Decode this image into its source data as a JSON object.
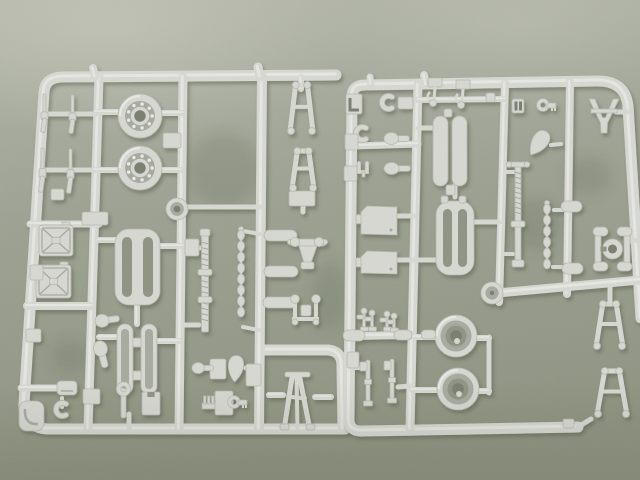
{
  "scene": {
    "kind": "photograph",
    "subject": "two light-grey injection-moulded plastic model-kit sprues (parts trees) with road wheels, bearing wheels, jerry cans, slotted plates, threaded rods, trestle frames, panels and small fittings",
    "surface": "olive-green textured mat"
  },
  "palette": {
    "bg_top": "#b4b7aa",
    "bg_mid": "#9da293",
    "bg_low": "#8e9381",
    "plastic": "#d7d8d2",
    "plastic_light": "#ecede8",
    "plastic_dark": "#b6b8ae",
    "plastic_deep": "#a7aa9f",
    "recess": "#8f9384",
    "hole": "#7a7e70",
    "highlight": "#dadccf",
    "cast_shadow": "#50553f"
  },
  "background": {
    "smudges": [
      {
        "cx": 224,
        "cy": 170,
        "rx": 38,
        "ry": 36
      },
      {
        "cx": 536,
        "cy": 224,
        "rx": 27,
        "ry": 26
      },
      {
        "cx": 588,
        "cy": 176,
        "rx": 23,
        "ry": 19
      },
      {
        "cx": 330,
        "cy": 296,
        "rx": 18,
        "ry": 34
      },
      {
        "cx": 70,
        "cy": 356,
        "rx": 18,
        "ry": 16
      }
    ]
  },
  "sprues": [
    {
      "name": "left-sprue",
      "frames": [
        "M336,75 L61,77 Q45,78 44,92 L24,404 Q23,427 47,429 L345,429",
        "M263,350 L328,350 Q341,351 342,364 L343,429"
      ],
      "lines": [
        [
          99,
          77,
          88,
          429,
          9
        ],
        [
          183,
          77,
          179,
          429,
          9
        ],
        [
          262,
          77,
          259,
          429,
          10
        ],
        [
          30,
          224,
          99,
          224,
          7
        ],
        [
          27,
          306,
          92,
          306,
          8
        ],
        [
          21,
          388,
          58,
          388,
          7
        ],
        [
          46,
          114,
          96,
          114,
          5
        ],
        [
          44,
          170,
          95,
          170,
          5
        ],
        [
          96,
          112,
          122,
          112,
          6
        ],
        [
          154,
          113,
          183,
          113,
          6
        ],
        [
          95,
          170,
          120,
          170,
          6
        ],
        [
          154,
          170,
          182,
          170,
          6
        ],
        [
          188,
          207,
          261,
          207,
          5
        ],
        [
          99,
          240,
          117,
          240,
          6
        ],
        [
          157,
          246,
          183,
          246,
          6
        ],
        [
          99,
          337,
          118,
          337,
          6
        ],
        [
          155,
          341,
          181,
          341,
          6
        ],
        [
          137,
          303,
          137,
          324,
          6
        ],
        [
          183,
          248,
          200,
          248,
          5
        ],
        [
          183,
          325,
          199,
          325,
          5
        ],
        [
          243,
          231,
          260,
          234,
          4
        ],
        [
          243,
          327,
          259,
          330,
          4
        ],
        [
          269,
          395,
          283,
          395,
          6
        ],
        [
          315,
          397,
          331,
          397,
          6
        ],
        [
          301,
          77,
          301,
          89,
          6
        ],
        [
          303,
          193,
          303,
          212,
          5
        ],
        [
          246,
          368,
          255,
          368,
          5
        ],
        [
          129,
          414,
          129,
          429,
          5
        ],
        [
          62,
          398,
          62,
          407,
          4
        ],
        [
          93,
          68,
          95,
          77,
          8
        ],
        [
          258,
          67,
          260,
          77,
          9
        ]
      ],
      "parts": [
        {
          "t": "rifle",
          "n": "rifle-part",
          "x": 43,
          "y": 94,
          "h": 39
        },
        {
          "t": "rifle",
          "n": "rifle-part",
          "x": 71,
          "y": 95,
          "h": 39
        },
        {
          "t": "rifle",
          "n": "rifle-part",
          "x": 41,
          "y": 148,
          "h": 45
        },
        {
          "t": "rifle",
          "n": "rifle-part",
          "x": 69,
          "y": 149,
          "h": 45
        },
        {
          "t": "box",
          "n": "small-block",
          "x": 51,
          "y": 189,
          "w": 13,
          "h": 11
        },
        {
          "t": "wheelL",
          "n": "bearing-wheel",
          "cx": 140,
          "cy": 116,
          "r": 22
        },
        {
          "t": "wheelL",
          "n": "bearing-wheel",
          "cx": 140,
          "cy": 168,
          "r": 22
        },
        {
          "t": "box",
          "n": "mounting-tab",
          "x": 163,
          "y": 133,
          "w": 18,
          "h": 15
        },
        {
          "t": "hub",
          "n": "wheel-hub",
          "cx": 177,
          "cy": 209,
          "r": 11
        },
        {
          "t": "ladder",
          "n": "trestle-frame",
          "x": 287,
          "y": 80,
          "w": 29,
          "h": 56
        },
        {
          "t": "box",
          "n": "mounting-tab",
          "x": 289,
          "y": 191,
          "w": 26,
          "h": 15
        },
        {
          "t": "ladder",
          "n": "trestle-frame",
          "x": 289,
          "y": 146,
          "w": 28,
          "h": 47
        },
        {
          "t": "xcan",
          "n": "jerry-can",
          "x": 39,
          "y": 225,
          "w": 34,
          "h": 31
        },
        {
          "t": "xcan",
          "n": "jerry-can",
          "x": 36,
          "y": 265,
          "w": 35,
          "h": 33
        },
        {
          "t": "box",
          "n": "mounting-tab",
          "x": 82,
          "y": 212,
          "w": 26,
          "h": 13
        },
        {
          "t": "slotplate",
          "n": "slotted-plate",
          "x": 115,
          "y": 229,
          "w": 45,
          "h": 76
        },
        {
          "t": "twincapsule",
          "n": "twin-capsule-frame",
          "x": 117,
          "y": 324,
          "w": 40,
          "h": 70
        },
        {
          "t": "box",
          "n": "mounting-tab",
          "x": 185,
          "y": 239,
          "w": 14,
          "h": 17
        },
        {
          "t": "screw",
          "n": "threaded-rod",
          "x": 205,
          "y": 234,
          "h": 98
        },
        {
          "t": "chain",
          "n": "linked-rod",
          "x": 241,
          "y": 227,
          "h": 104
        },
        {
          "t": "capsule",
          "n": "cylinder-part",
          "x": 264,
          "y": 230,
          "w": 33,
          "h": 11
        },
        {
          "t": "capsule",
          "n": "cylinder-part",
          "x": 264,
          "y": 266,
          "w": 34,
          "h": 11
        },
        {
          "t": "mountA",
          "n": "mount-bracket",
          "x": 288,
          "y": 236
        },
        {
          "t": "capsule",
          "n": "cylinder-part",
          "x": 263,
          "y": 297,
          "w": 34,
          "h": 11
        },
        {
          "t": "mountB",
          "n": "mount-bracket",
          "x": 287,
          "y": 294
        },
        {
          "t": "box",
          "n": "mounting-tab",
          "x": 246,
          "y": 364,
          "w": 15,
          "h": 22
        },
        {
          "t": "teardrop",
          "n": "teardrop-part",
          "cx": 236,
          "cy": 365,
          "r": 9.5,
          "rot": 5
        },
        {
          "t": "aframe",
          "n": "a-frame-leg",
          "x": 281,
          "y": 372,
          "w": 33,
          "h": 58
        },
        {
          "t": "paddle",
          "n": "paddle-part",
          "x": 95,
          "y": 313,
          "w": 25,
          "h": 14,
          "rot": -8
        },
        {
          "t": "paddle",
          "n": "paddle-part",
          "x": 88,
          "y": 347,
          "w": 28,
          "h": 15,
          "rot": 75
        },
        {
          "t": "box",
          "n": "mounting-tab",
          "x": 210,
          "y": 359,
          "w": 16,
          "h": 20
        },
        {
          "t": "paddle",
          "n": "paddle-part",
          "x": 192,
          "y": 362,
          "w": 22,
          "h": 12,
          "rot": 0
        },
        {
          "t": "chook",
          "n": "c-hook",
          "x": 55,
          "y": 402
        },
        {
          "t": "cornerpart",
          "n": "corner-plate",
          "x": 19,
          "y": 401,
          "w": 25,
          "h": 30
        },
        {
          "t": "box",
          "n": "small-block",
          "x": 30,
          "y": 265,
          "w": 13,
          "h": 15
        },
        {
          "t": "box",
          "n": "small-block",
          "x": 26,
          "y": 329,
          "w": 15,
          "h": 13
        },
        {
          "t": "shoe",
          "n": "small-part",
          "x": 57,
          "y": 381,
          "w": 20,
          "h": 14
        },
        {
          "t": "box",
          "n": "small-block",
          "x": 83,
          "y": 389,
          "w": 17,
          "h": 15
        },
        {
          "t": "wrench",
          "n": "wrench-part",
          "x": 120,
          "y": 383
        },
        {
          "t": "nbox",
          "n": "notched-block",
          "x": 142,
          "y": 392,
          "w": 18,
          "h": 23
        },
        {
          "t": "comb",
          "n": "comb-bracket",
          "x": 202,
          "y": 396
        },
        {
          "t": "box",
          "n": "small-block",
          "x": 215,
          "y": 391,
          "w": 18,
          "h": 24
        },
        {
          "t": "okey",
          "n": "ring-key",
          "x": 229,
          "y": 396
        }
      ]
    },
    {
      "name": "right-sprue",
      "frames": [
        "M578,427 L363,431 Q348,432 349,417 L352,97 Q352,85 365,85 L596,81 Q625,80 628,106 L641,318"
      ],
      "lines": [
        [
          418,
          85,
          410,
          429,
          9
        ],
        [
          505,
          83,
          499,
          302,
          8
        ],
        [
          570,
          82,
          567,
          294,
          8
        ],
        [
          352,
          146,
          418,
          144,
          7
        ],
        [
          418,
          100,
          505,
          99,
          6
        ],
        [
          497,
          293,
          640,
          280,
          9
        ],
        [
          352,
          336,
          412,
          335,
          8
        ],
        [
          489,
          337,
          489,
          393,
          5
        ],
        [
          396,
          216,
          416,
          216,
          5
        ],
        [
          396,
          260,
          437,
          260,
          5
        ],
        [
          472,
          222,
          499,
          222,
          5
        ],
        [
          418,
          128,
          434,
          128,
          5
        ],
        [
          455,
          185,
          455,
          197,
          5
        ],
        [
          616,
          112,
          627,
          112,
          5
        ],
        [
          551,
          145,
          561,
          144,
          4
        ],
        [
          505,
          172,
          514,
          172,
          4
        ],
        [
          505,
          254,
          513,
          254,
          4
        ],
        [
          554,
          210,
          567,
          210,
          4
        ],
        [
          553,
          267,
          567,
          267,
          4
        ],
        [
          629,
          241,
          639,
          240,
          5
        ],
        [
          412,
          337,
          436,
          337,
          6
        ],
        [
          476,
          338,
          489,
          338,
          6
        ],
        [
          412,
          390,
          438,
          390,
          6
        ],
        [
          477,
          391,
          489,
          391,
          6
        ],
        [
          398,
          387,
          410,
          386,
          5
        ],
        [
          352,
          368,
          361,
          368,
          4
        ],
        [
          610,
          287,
          610,
          300,
          5
        ],
        [
          578,
          427,
          591,
          419,
          5
        ],
        [
          424,
          75,
          426,
          85,
          8
        ],
        [
          370,
          77,
          371,
          85,
          7
        ]
      ],
      "parts": [
        {
          "t": "lshape",
          "n": "l-bracket",
          "x": 346,
          "y": 94,
          "w": 16,
          "h": 20
        },
        {
          "t": "chook",
          "n": "c-hook",
          "x": 381,
          "y": 95
        },
        {
          "t": "box",
          "n": "small-block",
          "x": 398,
          "y": 97,
          "w": 15,
          "h": 12
        },
        {
          "t": "chook",
          "n": "c-hook",
          "x": 355,
          "y": 126
        },
        {
          "t": "box",
          "n": "small-block",
          "x": 345,
          "y": 134,
          "w": 13,
          "h": 16
        },
        {
          "t": "ufork",
          "n": "fork-part",
          "x": 359,
          "y": 163
        },
        {
          "t": "box",
          "n": "small-block",
          "x": 344,
          "y": 166,
          "w": 13,
          "h": 15
        },
        {
          "t": "paddle",
          "n": "paddle-part",
          "x": 384,
          "y": 132,
          "w": 26,
          "h": 13,
          "rot": 0
        },
        {
          "t": "paddle",
          "n": "paddle-part",
          "x": 384,
          "y": 162,
          "w": 27,
          "h": 13,
          "rot": 0
        },
        {
          "t": "hookasm",
          "n": "hook-assembly",
          "x": 428,
          "y": 78
        },
        {
          "t": "hookasm",
          "n": "hook-assembly",
          "x": 456,
          "y": 80
        },
        {
          "t": "box",
          "n": "small-block",
          "x": 486,
          "y": 93,
          "w": 9,
          "h": 9
        },
        {
          "t": "capsule",
          "n": "oval-pod",
          "x": 433,
          "y": 116,
          "w": 15,
          "h": 70
        },
        {
          "t": "capsule",
          "n": "oval-pod",
          "x": 452,
          "y": 116,
          "w": 15,
          "h": 70
        },
        {
          "t": "box",
          "n": "mounting-tab",
          "x": 444,
          "y": 109,
          "w": 8,
          "h": 8
        },
        {
          "t": "box",
          "n": "mounting-tab",
          "x": 446,
          "y": 185,
          "w": 9,
          "h": 10
        },
        {
          "t": "gridpart",
          "n": "grid-buckle",
          "x": 512,
          "y": 99
        },
        {
          "t": "okey",
          "n": "ring-key",
          "x": 538,
          "y": 99
        },
        {
          "t": "teardrop",
          "n": "teardrop-part",
          "cx": 541,
          "cy": 140,
          "r": 10,
          "rot": 35
        },
        {
          "t": "vfork",
          "n": "fork-mount",
          "x": 589,
          "y": 99,
          "w": 30,
          "h": 34
        },
        {
          "t": "panel",
          "n": "hatch-panel",
          "x": 361,
          "y": 206,
          "w": 36,
          "h": 29
        },
        {
          "t": "panel",
          "n": "hatch-panel",
          "x": 361,
          "y": 251,
          "w": 36,
          "h": 23
        },
        {
          "t": "slotplate",
          "n": "slotted-plate",
          "x": 436,
          "y": 201,
          "w": 38,
          "h": 74
        },
        {
          "t": "box",
          "n": "mounting-tab",
          "x": 441,
          "y": 196,
          "w": 7,
          "h": 7
        },
        {
          "t": "box",
          "n": "mounting-tab",
          "x": 459,
          "y": 196,
          "w": 7,
          "h": 7
        },
        {
          "t": "screwjack",
          "n": "jack-screw",
          "x": 518,
          "y": 166,
          "h": 100
        },
        {
          "t": "chain",
          "n": "linked-rod",
          "x": 547,
          "y": 201,
          "h": 78
        },
        {
          "t": "capsule",
          "n": "cylinder-part",
          "x": 561,
          "y": 201,
          "w": 21,
          "h": 11
        },
        {
          "t": "capsule",
          "n": "cylinder-part",
          "x": 562,
          "y": 263,
          "w": 21,
          "h": 11
        },
        {
          "t": "hshoe",
          "n": "axle-bracket",
          "x": 593,
          "y": 227,
          "w": 39,
          "h": 44
        },
        {
          "t": "boss",
          "n": "round-boss",
          "cx": 492,
          "cy": 293,
          "r": 11
        },
        {
          "t": "wheelR",
          "n": "tire-wheel",
          "cx": 456,
          "cy": 336,
          "r": 21
        },
        {
          "t": "wheelR",
          "n": "tire-wheel",
          "cx": 458,
          "cy": 389,
          "r": 21
        },
        {
          "t": "pinfig",
          "n": "lever-part",
          "x": 364,
          "y": 308,
          "h": 22
        },
        {
          "t": "pinfig",
          "n": "lever-part",
          "x": 372,
          "y": 310,
          "h": 20
        },
        {
          "t": "pinfig",
          "n": "lever-part",
          "x": 387,
          "y": 311,
          "h": 19
        },
        {
          "t": "pinfig",
          "n": "lever-part",
          "x": 394,
          "y": 313,
          "h": 18
        },
        {
          "t": "capsule",
          "n": "cylinder-part",
          "x": 343,
          "y": 330,
          "w": 22,
          "h": 11
        },
        {
          "t": "capsule",
          "n": "cylinder-part",
          "x": 394,
          "y": 330,
          "w": 18,
          "h": 10
        },
        {
          "t": "capsule",
          "n": "cylinder-part",
          "x": 421,
          "y": 330,
          "w": 15,
          "h": 9
        },
        {
          "t": "pin",
          "n": "pin-part",
          "x": 368,
          "y": 360,
          "h": 46
        },
        {
          "t": "pin",
          "n": "pin-part",
          "x": 392,
          "y": 359,
          "h": 44
        },
        {
          "t": "box",
          "n": "small-block",
          "x": 347,
          "y": 352,
          "w": 12,
          "h": 16
        },
        {
          "t": "ladder",
          "n": "ladder-frame",
          "x": 593,
          "y": 299,
          "w": 33,
          "h": 52
        },
        {
          "t": "ladder",
          "n": "ladder-frame",
          "x": 594,
          "y": 366,
          "w": 36,
          "h": 53
        },
        {
          "t": "box",
          "n": "small-block",
          "x": 563,
          "y": 419,
          "w": 11,
          "h": 9
        }
      ]
    }
  ]
}
